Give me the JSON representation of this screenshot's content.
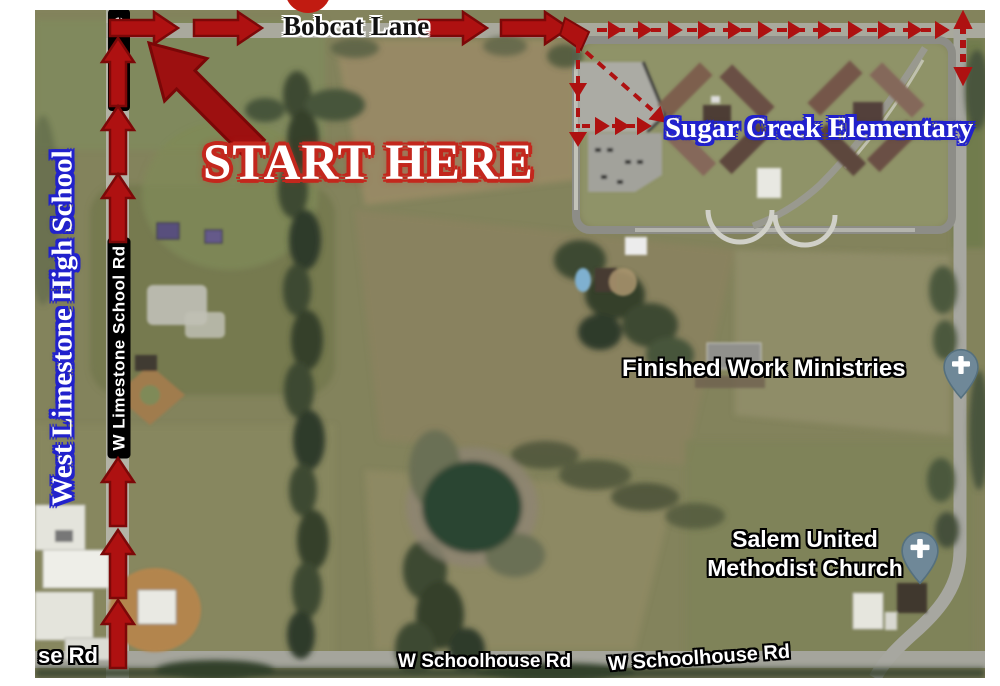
{
  "map": {
    "type": "annotated-satellite-route-map",
    "labels": {
      "bobcat_lane": "Bobcat Lane",
      "start_here": "START HERE",
      "sugar_creek_elementary": "Sugar Creek Elementary",
      "west_limestone_high_school": "West Limestone High School",
      "w_limestone_school_rd": "W Limestone School Rd",
      "partial_road_label": "e",
      "finished_work_ministries": "Finished Work Ministries",
      "salem_united_line1": "Salem United",
      "salem_united_line2": "Methodist Church",
      "w_schoolhouse_rd_center": "W Schoolhouse Rd",
      "w_schoolhouse_rd_right": "W Schoolhouse Rd",
      "se_rd": "se Rd"
    },
    "icons": {
      "church_pin_finished_work": "church-map-pin",
      "church_pin_salem": "church-map-pin",
      "start_marker_circle": "red-circle-marker"
    },
    "colors": {
      "route_arrow_fill": "#ae1111",
      "route_arrow_outline": "#7c0808",
      "start_here_outline": "#c3271d",
      "school_label_outline": "#2121cc",
      "road_label_background": "#000000",
      "map_pin_fill": "#6f8898",
      "pond": "#2c4431"
    }
  }
}
